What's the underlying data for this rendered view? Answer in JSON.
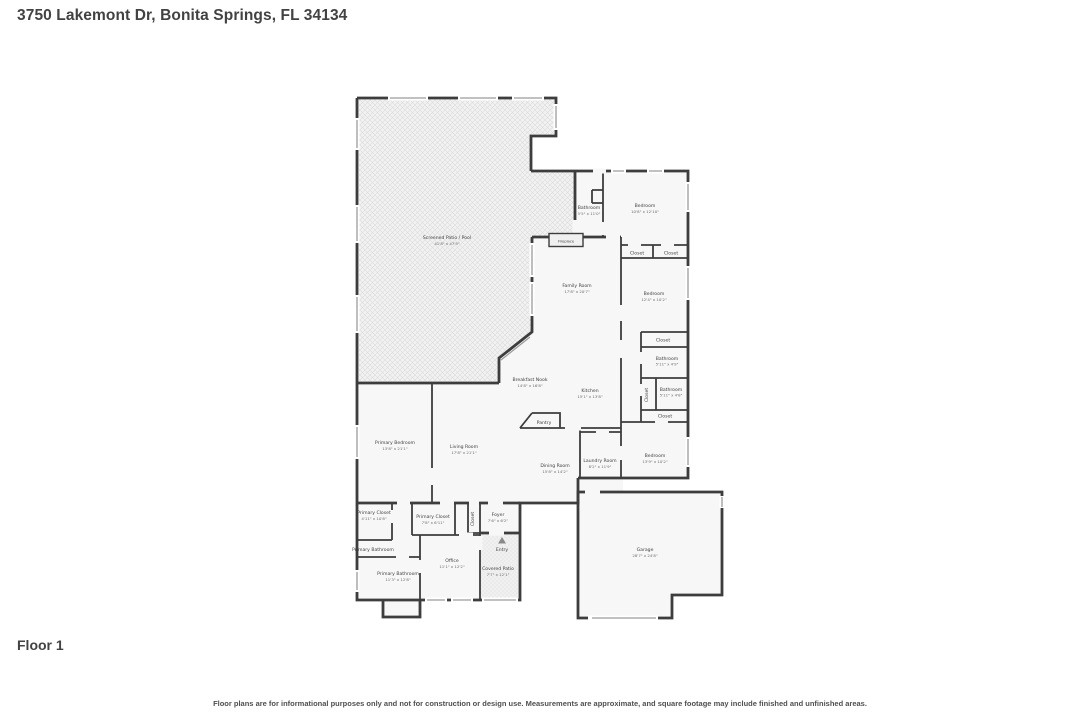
{
  "header": {
    "address": "3750 Lakemont Dr, Bonita Springs, FL 34134"
  },
  "floor": {
    "label": "Floor 1"
  },
  "footer": {
    "disclaimer": "Floor plans are for informational purposes only and not for construction or design use. Measurements are approximate, and square footage may include finished and unfinished areas."
  },
  "colors": {
    "wall": "#3d3d3d",
    "room_fill": "#f7f7f7",
    "patio_fill": "#f2f2f2",
    "hatch_line": "#dcdcdc",
    "label_text": "#3f3f3f"
  },
  "plan": {
    "rooms": {
      "screened_patio_pool": {
        "name": "Screened Patio / Pool",
        "dims": "41'8\" x 47'9\""
      },
      "bathroom_pool": {
        "name": "Bathroom",
        "dims": "5'5\" x 11'0\""
      },
      "bedroom_ne": {
        "name": "Bedroom",
        "dims": "10'8\" x 12'10\""
      },
      "closet_ne_1": {
        "name": "Closet"
      },
      "closet_ne_2": {
        "name": "Closet"
      },
      "fireplace": {
        "name": "Fireplace"
      },
      "family_room": {
        "name": "Family Room",
        "dims": "17'8\" x 20'7\""
      },
      "bedroom_e": {
        "name": "Bedroom",
        "dims": "12'4\" x 10'2\""
      },
      "closet_e_1": {
        "name": "Closet"
      },
      "bathroom_e_1": {
        "name": "Bathroom",
        "dims": "5'11\" x 4'9\""
      },
      "closet_e_2": {
        "name": "Closet"
      },
      "bathroom_e_2": {
        "name": "Bathroom",
        "dims": "5'11\" x 4'8\""
      },
      "closet_e_3": {
        "name": "Closet"
      },
      "breakfast_nook": {
        "name": "Breakfast Nook",
        "dims": "14'8\" x 16'8\""
      },
      "kitchen": {
        "name": "Kitchen",
        "dims": "15'1\" x 13'8\""
      },
      "pantry": {
        "name": "Pantry"
      },
      "primary_bedroom": {
        "name": "Primary Bedroom",
        "dims": "13'8\" x 21'1\""
      },
      "living_room": {
        "name": "Living Room",
        "dims": "17'8\" x 21'1\""
      },
      "dining_room": {
        "name": "Dining Room",
        "dims": "15'8\" x 14'2\""
      },
      "laundry_room": {
        "name": "Laundry Room",
        "dims": "8'2\" x 11'9\""
      },
      "bedroom_se": {
        "name": "Bedroom",
        "dims": "13'9\" x 10'2\""
      },
      "primary_closet_1": {
        "name": "Primary Closet",
        "dims": "4'11\" x 10'8\""
      },
      "primary_closet_2": {
        "name": "Primary Closet",
        "dims": "7'8\" x 6'11\""
      },
      "closet_foyer": {
        "name": "Closet"
      },
      "foyer": {
        "name": "Foyer",
        "dims": "7'6\" x 6'2\""
      },
      "primary_bathroom_small": {
        "name": "Primary Bathroom"
      },
      "primary_bathroom": {
        "name": "Primary Bathroom",
        "dims": "11'3\" x 12'8\""
      },
      "office": {
        "name": "Office",
        "dims": "11'1\" x 12'2\""
      },
      "entry": {
        "name": "Entry"
      },
      "covered_patio": {
        "name": "Covered Patio",
        "dims": "7'7\" x 12'1\""
      },
      "garage": {
        "name": "Garage",
        "dims": "28'7\" x 24'8\""
      }
    }
  }
}
